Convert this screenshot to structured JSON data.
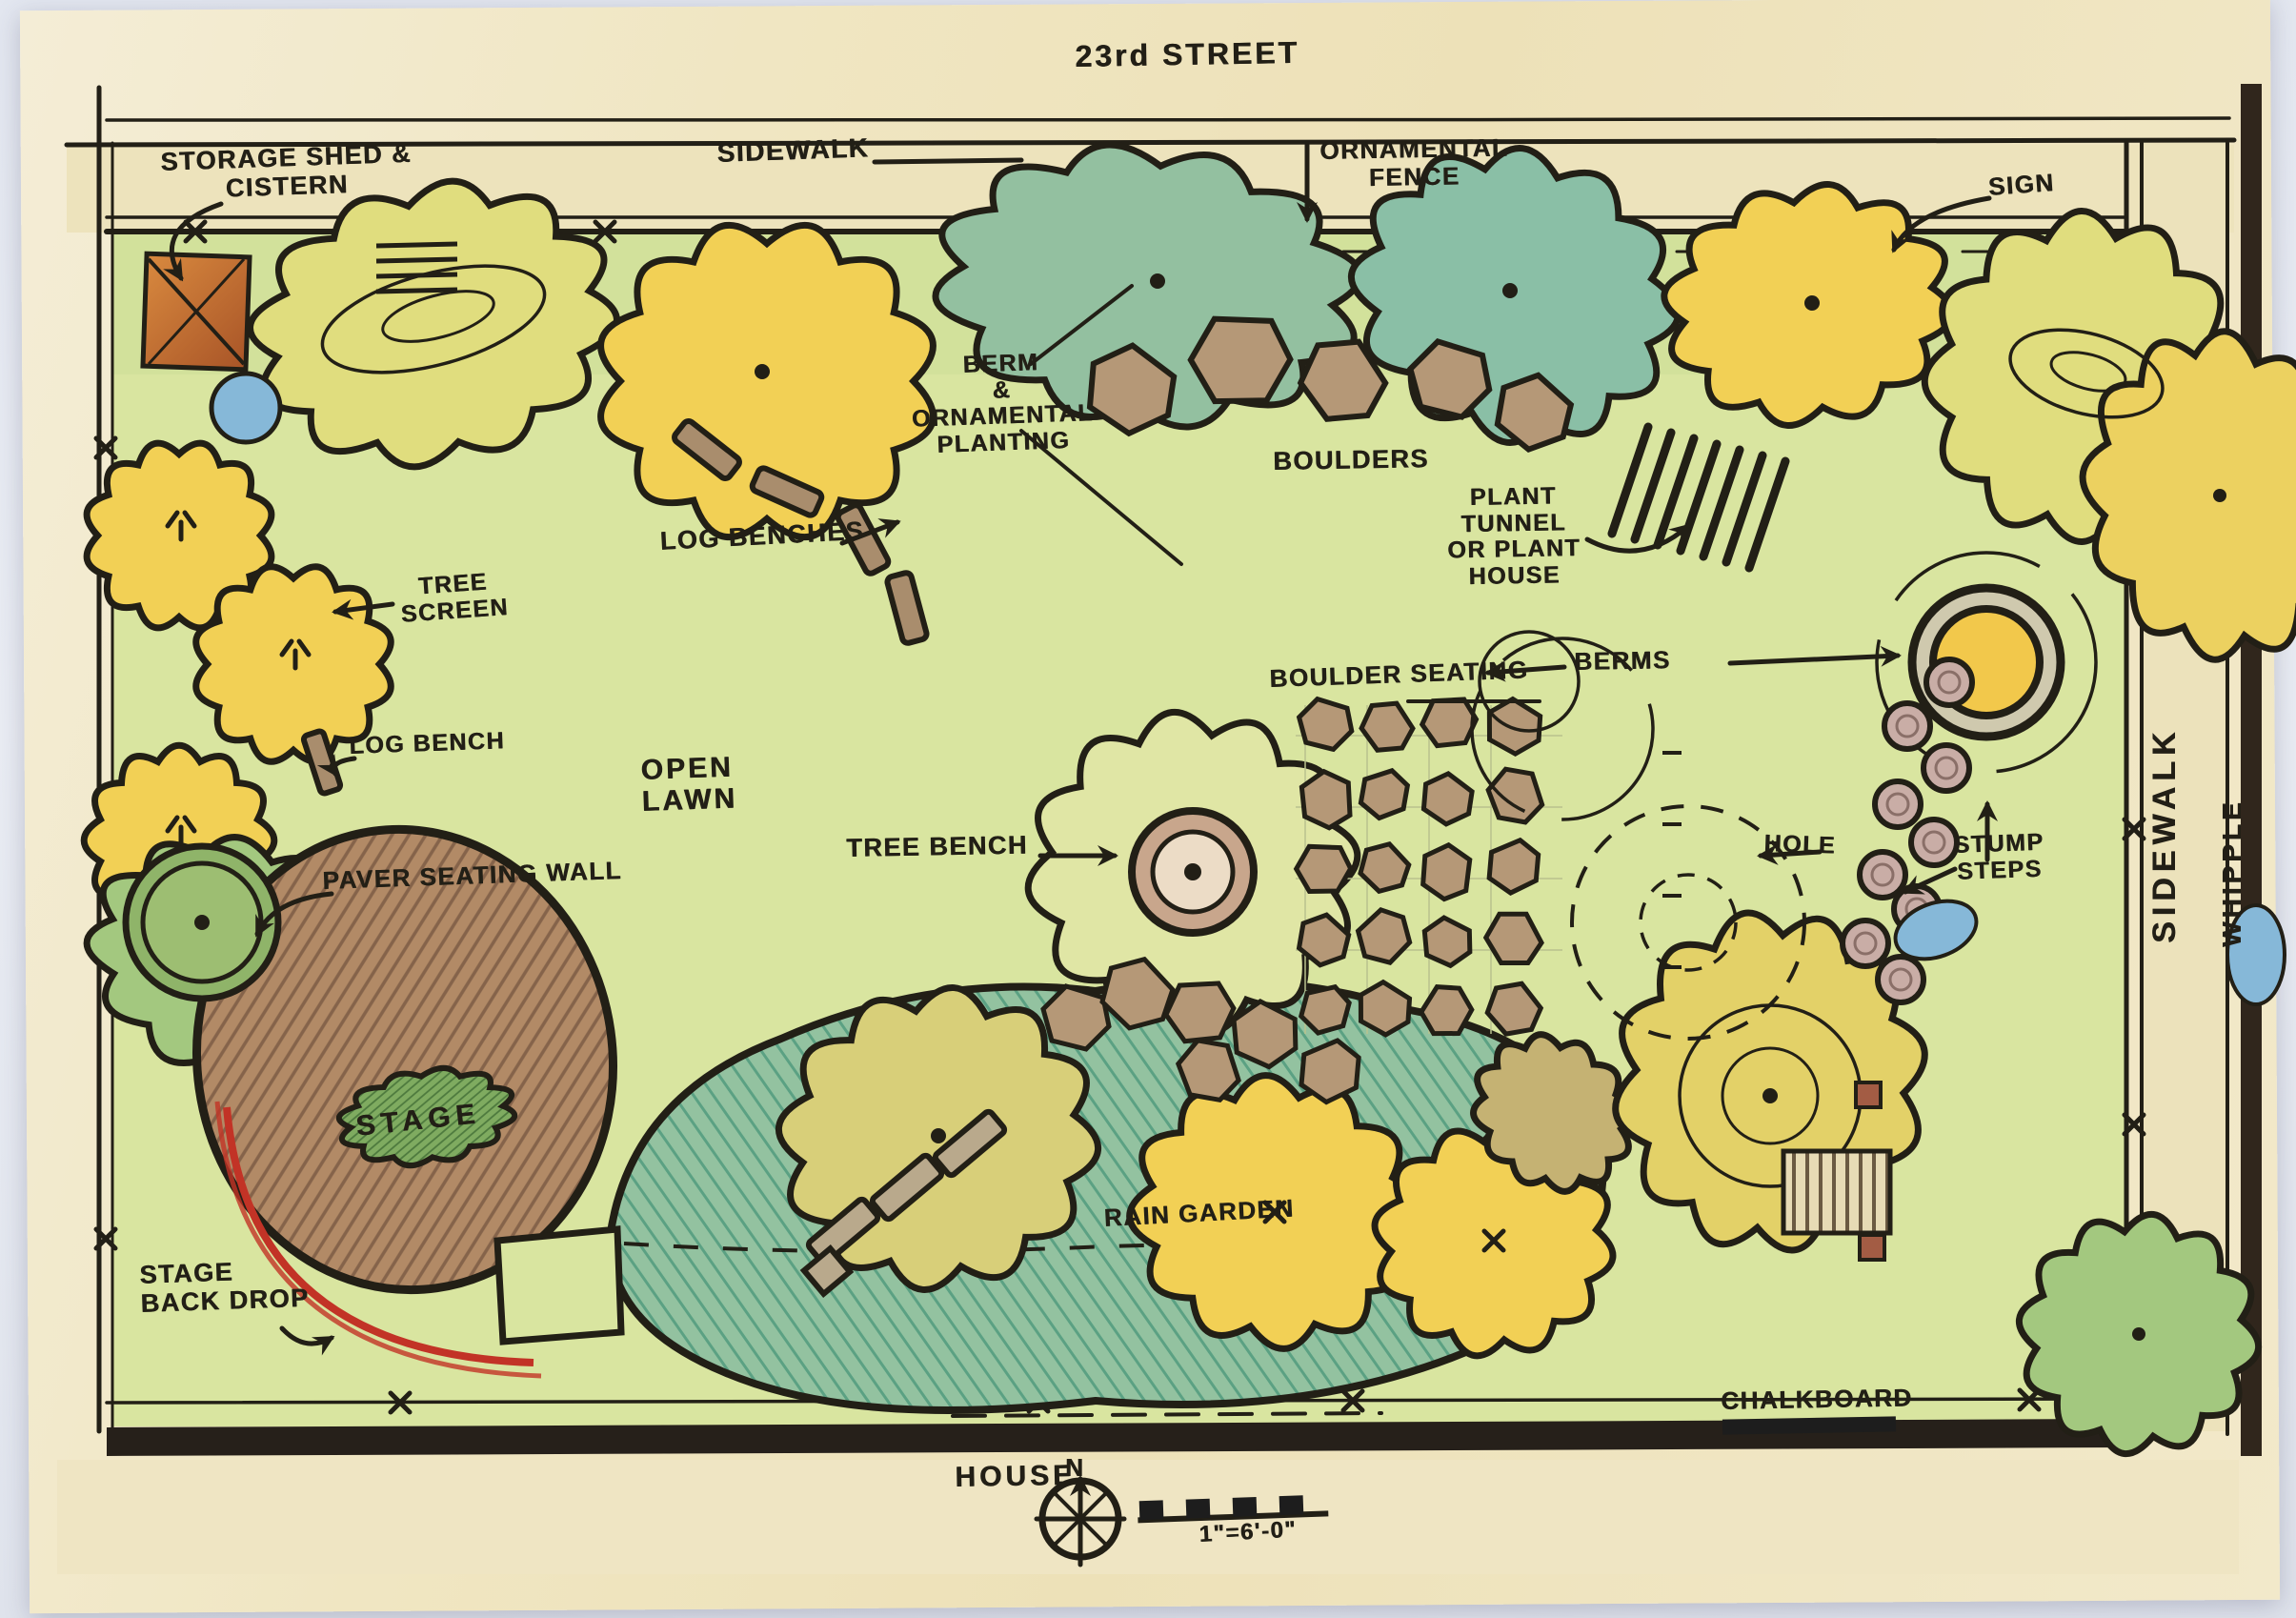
{
  "meta": {
    "type": "hand-drawn landscape architecture site plan",
    "medium": "marker and colored pencil sketch"
  },
  "labels": {
    "street": "23rd STREET",
    "sidewalk_top": "SIDEWALK",
    "ornamental_fence": "ORNAMENTAL\nFENCE",
    "sign": "SIGN",
    "storage_shed": "STORAGE SHED &\nCISTERN",
    "berm_planting": "BERM\n&\nORNAMENTAL\nPLANTING",
    "boulders": "BOULDERS",
    "plant_tunnel": "PLANT TUNNEL\nOR PLANT\nHOUSE",
    "log_benches": "LOG BENCHES",
    "tree_screen": "TREE\nSCREEN",
    "log_bench": "LOG BENCH",
    "open_lawn": "OPEN\nLAWN",
    "tree_bench": "TREE BENCH",
    "boulder_seating": "BOULDER SEATING",
    "berms": "BERMS",
    "hole": "HOLE",
    "stump_steps": "STUMP\nSTEPS",
    "paver_wall": "PAVER SEATING WALL",
    "stage": "STAGE",
    "stage_backdrop": "STAGE\nBACK DROP",
    "rain_garden": "RAIN GARDEN",
    "chalkboard": "CHALKBOARD",
    "house": "HOUSE",
    "sidewalk_right": "SIDEWALK",
    "street_right": "WHIPPLE",
    "north": "N",
    "scale": "1\"=6'-0\""
  },
  "colors": {
    "ink": "#221f16",
    "paper": "#f0e6c2",
    "lawn": "#d9e5a0",
    "canopy_yellow": "#f2d055",
    "canopy_yellow_green": "#e0dd7e",
    "canopy_green": "#a3c87f",
    "canopy_teal": "#93c0a0",
    "stage_brown": "#b28a66",
    "boulder_brown": "#b59877",
    "stump_pink": "#c9ada6",
    "shed_orange": "#cd7c3a",
    "cistern_blue": "#86b8d8",
    "berm_yellow": "#f2c84b",
    "backdrop_red": "#c23326"
  }
}
